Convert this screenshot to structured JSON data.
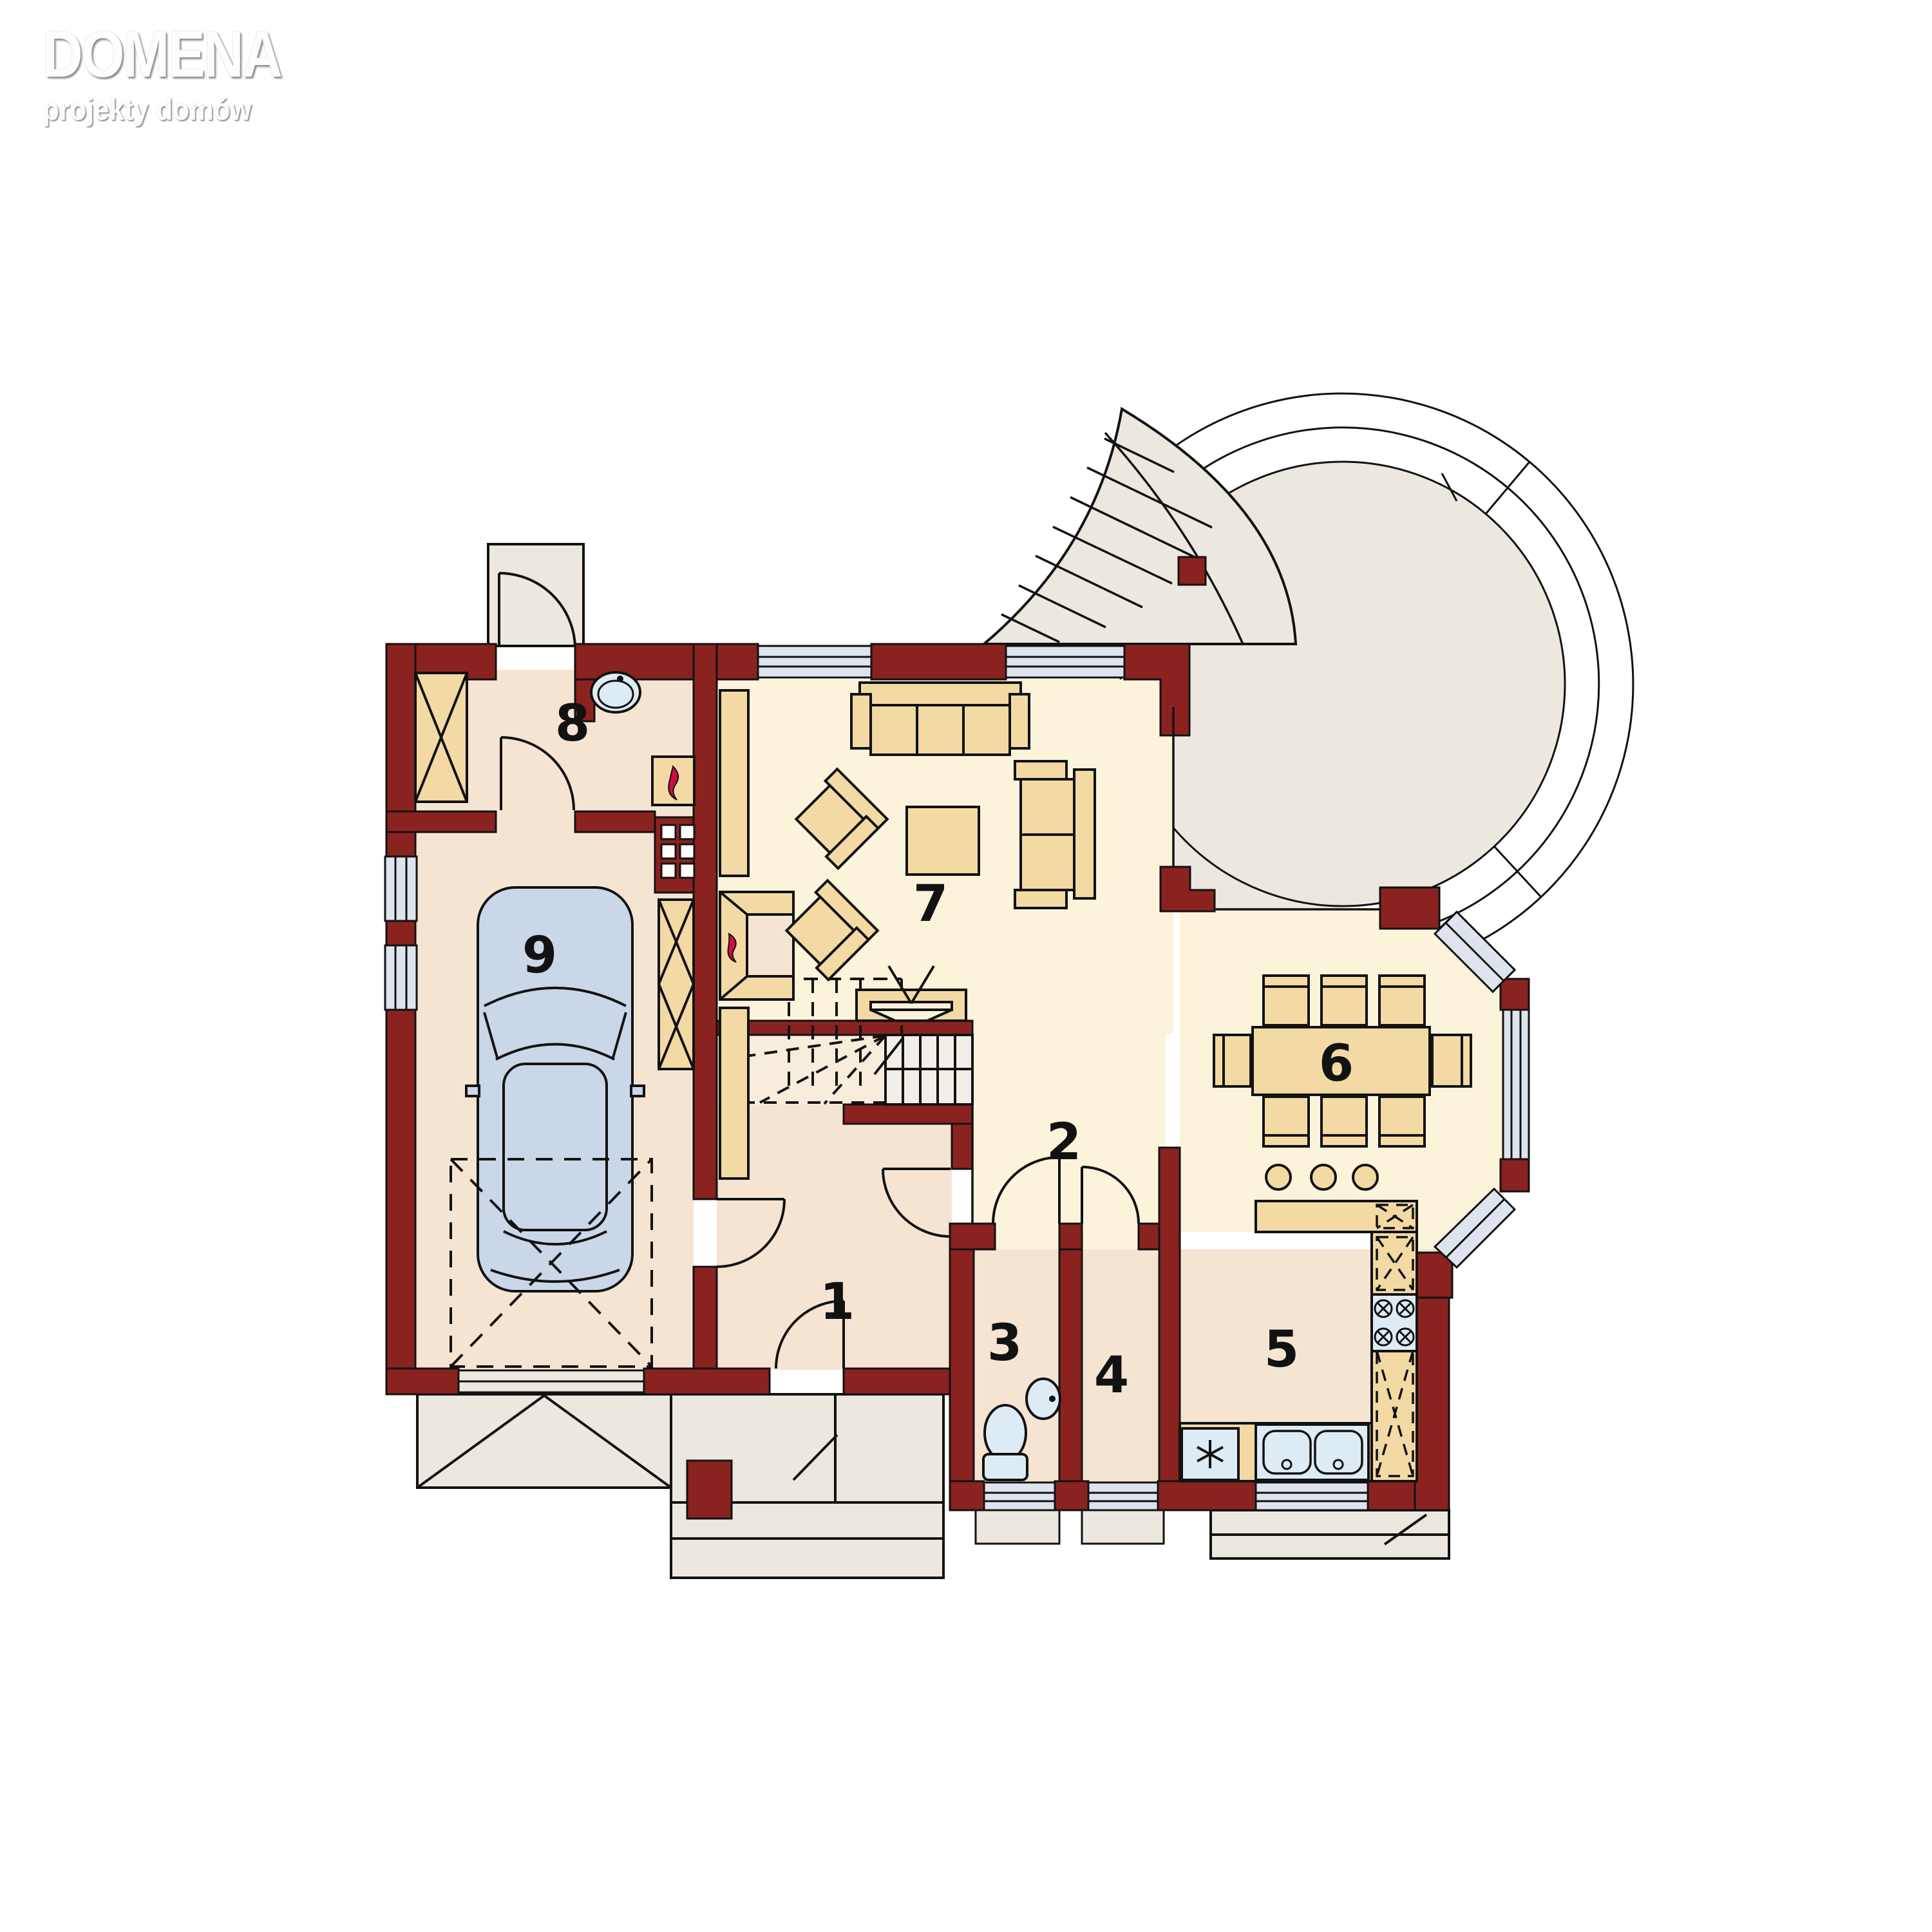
{
  "logo": {
    "title": "DOMENA",
    "subtitle": "projekty domów"
  },
  "plan": {
    "rooms": [
      {
        "id": "vestibule",
        "label": "1"
      },
      {
        "id": "hall",
        "label": "2"
      },
      {
        "id": "wc",
        "label": "3"
      },
      {
        "id": "pantry",
        "label": "4"
      },
      {
        "id": "kitchen",
        "label": "5"
      },
      {
        "id": "dining-room",
        "label": "6"
      },
      {
        "id": "living-room",
        "label": "7"
      },
      {
        "id": "utility-room",
        "label": "8"
      },
      {
        "id": "garage",
        "label": "9"
      }
    ],
    "colors": {
      "wall": "#8a2320",
      "room_warm": "#f6e4d2",
      "room_light": "#fbf3da",
      "furniture": "#f3d9a4",
      "glass": "#dde4ed",
      "exterior": "#ece8e0",
      "car": "#c9d7e8",
      "fixture": "#ddebf5",
      "flame": "#ce0d42"
    }
  }
}
